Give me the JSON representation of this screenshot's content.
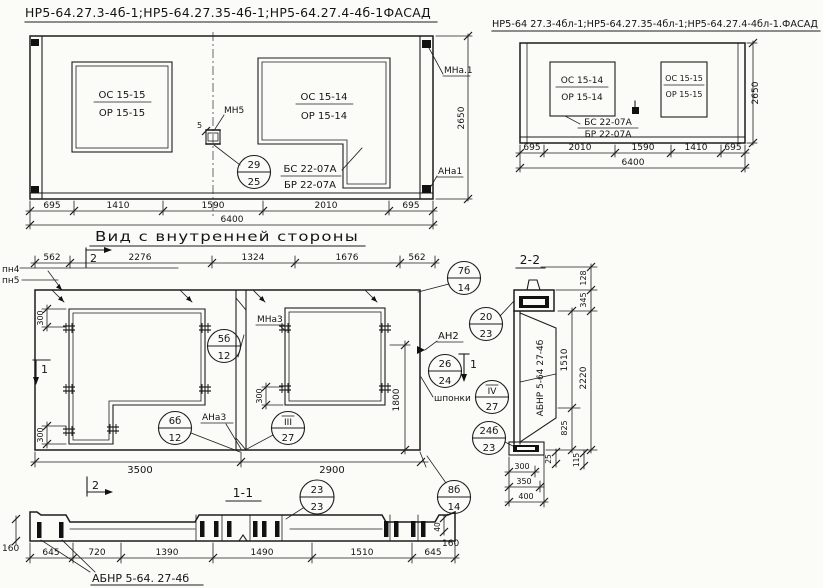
{
  "facade_left": {
    "title": "НР5-64.27.3-4б-1;НР5-64.27.35-4б-1;НР5-64.27.4-4б-1ФАСАД",
    "win_left": {
      "num": "ОС 15-15",
      "den": "ОР 15-15"
    },
    "win_right": {
      "num": "ОС 15-14",
      "den": "ОР 15-14"
    },
    "sill": {
      "num": "БС 22-07А",
      "den": "БР 22-07А"
    },
    "mn5_label": "МН5",
    "dim5": "5",
    "callout_29": {
      "num": "29",
      "den": "25"
    },
    "mna1_label": "МНа.1",
    "ana1_label": "АНа1",
    "dim_height": "2650",
    "dims": [
      "695",
      "1410",
      "1590",
      "2010",
      "695"
    ],
    "dim_total": "6400"
  },
  "facade_right": {
    "title": "НР5-64 27.3-4бл-1;НР5-64.27.35-4бл-1;НР5-64.27.4-4бл-1.ФАСАД",
    "win_left": {
      "num": "ОС 15-14",
      "den": "ОР 15-14"
    },
    "win_right": {
      "num": "ОС 15-15",
      "den": "ОР 15-15"
    },
    "sill": {
      "num": "БС 22-07А",
      "den": "БР 22-07А"
    },
    "dim_height": "2650",
    "dims": [
      "695",
      "2010",
      "1590",
      "1410",
      "695"
    ],
    "dim_total": "6400"
  },
  "inner_view": {
    "title": "Вид с внутренней стороны",
    "dims_top": [
      "562",
      "2276",
      "1324",
      "1676",
      "562"
    ],
    "pn4": "пн4",
    "pn5": "пн5",
    "sec_mark_2": "2",
    "sec_mark_1": "1",
    "dim300_a": "300",
    "dim300_b": "300",
    "dim300_c": "300",
    "dim1800": "1800",
    "dim3500": "3500",
    "dim2900": "2900",
    "mna3_label": "МНа3",
    "ana3_label": "АНа3",
    "an2_label": "АН2",
    "shponki_label": "шпонки",
    "c5b": {
      "num": "5б",
      "den": "12"
    },
    "c6b": {
      "num": "6б",
      "den": "12"
    },
    "c3": {
      "num": "III",
      "den": "27"
    },
    "c7b": {
      "num": "7б",
      "den": "14"
    },
    "c20": {
      "num": "20",
      "den": "23"
    },
    "c26": {
      "num": "26",
      "den": "24"
    },
    "c4": {
      "num": "IV",
      "den": "27"
    },
    "c24b": {
      "num": "24б",
      "den": "23"
    }
  },
  "section22": {
    "title": "2-2",
    "member_label": "АБНР 5-64 27-4б",
    "d128": "128",
    "d345": "345",
    "d1510": "1510",
    "d2220": "2220",
    "d825": "825",
    "d25": "25",
    "d115": "115",
    "d300": "300",
    "d350": "350",
    "d400": "400"
  },
  "section11": {
    "title": "1-1",
    "member_label": "АБНР 5-64. 27-4б",
    "c23": {
      "num": "23",
      "den": "23"
    },
    "c8b": {
      "num": "8б",
      "den": "14"
    },
    "d160l": "160",
    "d160r": "160",
    "d40": "40",
    "sec_mark_2": "2",
    "dims": [
      "645",
      "720",
      "1390",
      "1490",
      "1510",
      "645"
    ]
  }
}
